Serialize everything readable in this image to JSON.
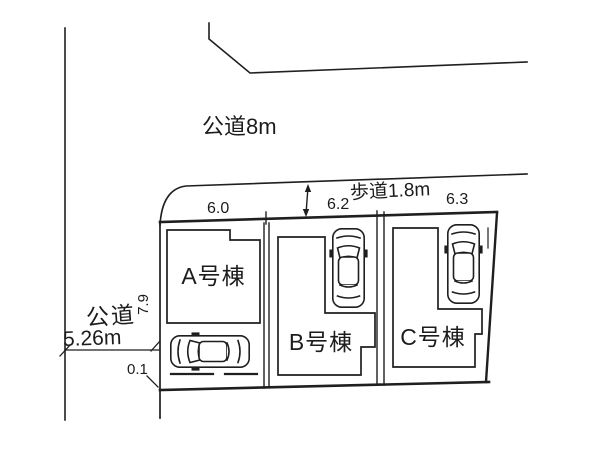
{
  "figure": {
    "kind": "residential-site-plan",
    "background_color": "#ffffff",
    "line_color": "#1f1f1f"
  },
  "roads": {
    "north_road_label": "公道8m",
    "sidewalk_label": "歩道1.8m",
    "west_road_name": "公道",
    "west_road_width": "5.26m"
  },
  "lots": [
    {
      "label": "A号棟",
      "frontage": "6.0"
    },
    {
      "label": "B号棟",
      "frontage": "6.2"
    },
    {
      "label": "C号棟",
      "frontage": "6.3"
    }
  ],
  "dimensions": {
    "lot_a_west_depth": "7.9",
    "corner_offset": "0.1"
  },
  "icons": {
    "car": "car-top-view-icon"
  }
}
